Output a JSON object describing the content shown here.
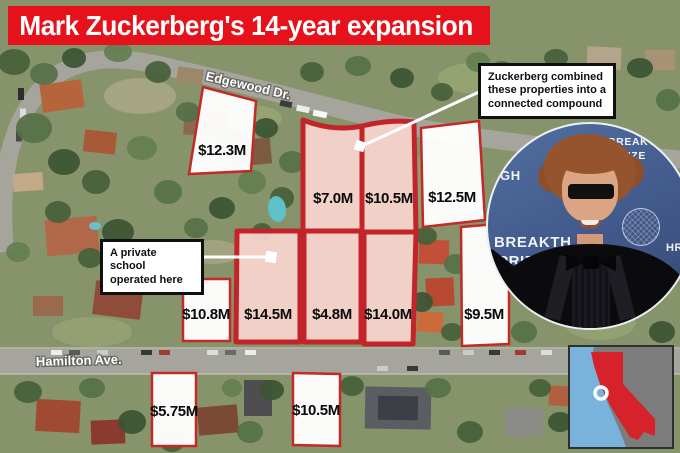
{
  "title": {
    "text": "Mark Zuckerberg's 14-year expansion"
  },
  "callouts": {
    "compound": {
      "text": "Zuckerberg combined these properties into a connected compound"
    },
    "school": {
      "text": "A private school operated here"
    }
  },
  "streets": {
    "edgewood": "Edgewood Dr.",
    "hamilton": "Hamilton Ave."
  },
  "parcels": {
    "compound": [
      {
        "label": "$7.0M"
      },
      {
        "label": "$10.5M"
      },
      {
        "label": "$14.5M"
      },
      {
        "label": "$4.8M"
      },
      {
        "label": "$14.0M"
      }
    ],
    "standalone": [
      {
        "label": "$12.3M"
      },
      {
        "label": "$12.5M"
      },
      {
        "label": "$9.5M"
      },
      {
        "label": "$10.8M"
      },
      {
        "label": "$5.75M"
      },
      {
        "label": "$10.5M"
      }
    ]
  },
  "photo": {
    "fragments": [
      "GH",
      "BREAKTH",
      "PRIZE",
      "BREAKTHRO",
      "PRIZE",
      "HROU"
    ]
  },
  "colors": {
    "banner_red": "#e6111b",
    "compound_fill": "#f7d3cd",
    "compound_border": "#c2242a",
    "white_parcel_border": "#c22a28",
    "california_red": "#d6222b",
    "ocean_blue": "#79b2da",
    "land_gray": "#7c7c7c"
  }
}
